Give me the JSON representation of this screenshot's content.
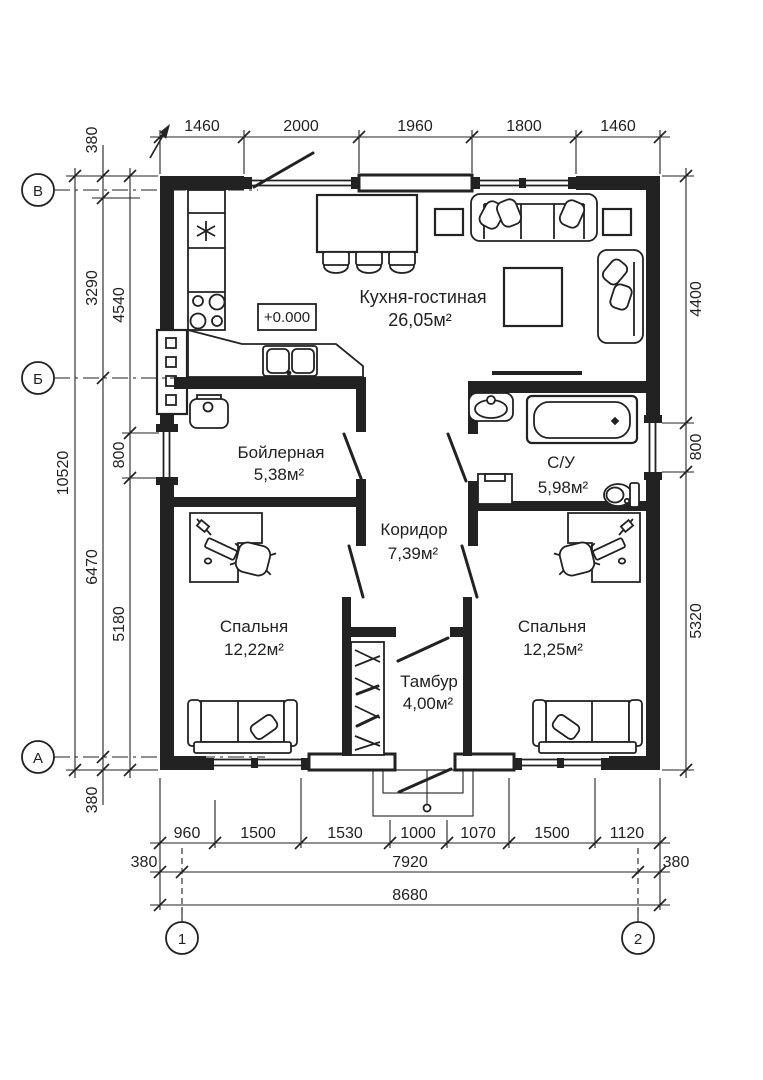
{
  "elevation": {
    "value": "+0.000"
  },
  "axes": {
    "rows": [
      {
        "label": "В"
      },
      {
        "label": "Б"
      },
      {
        "label": "А"
      }
    ],
    "cols": [
      {
        "label": "1"
      },
      {
        "label": "2"
      }
    ]
  },
  "rooms": [
    {
      "name": "Кухня-гостиная",
      "area": "26,05м²"
    },
    {
      "name": "Бойлерная",
      "area": "5,38м²"
    },
    {
      "name": "С/У",
      "area": "5,98м²"
    },
    {
      "name": "Коридор",
      "area": "7,39м²"
    },
    {
      "name": "Спальня",
      "area": "12,22м²"
    },
    {
      "name": "Спальня",
      "area": "12,25м²"
    },
    {
      "name": "Тамбур",
      "area": "4,00м²"
    }
  ],
  "dims": {
    "top": [
      "1460",
      "2000",
      "1960",
      "1800",
      "1460"
    ],
    "left_total": "10520",
    "left_mid": [
      "380",
      "3290",
      "6470",
      "380"
    ],
    "left_inner": [
      "4540",
      "800",
      "5180"
    ],
    "right": [
      "4400",
      "800",
      "5320"
    ],
    "bottom_segments": [
      "960",
      "1500",
      "1530",
      "1000",
      "1070",
      "1500",
      "1120"
    ],
    "bottom_mid": [
      "380",
      "7920",
      "380"
    ],
    "bottom_total": "8680"
  }
}
